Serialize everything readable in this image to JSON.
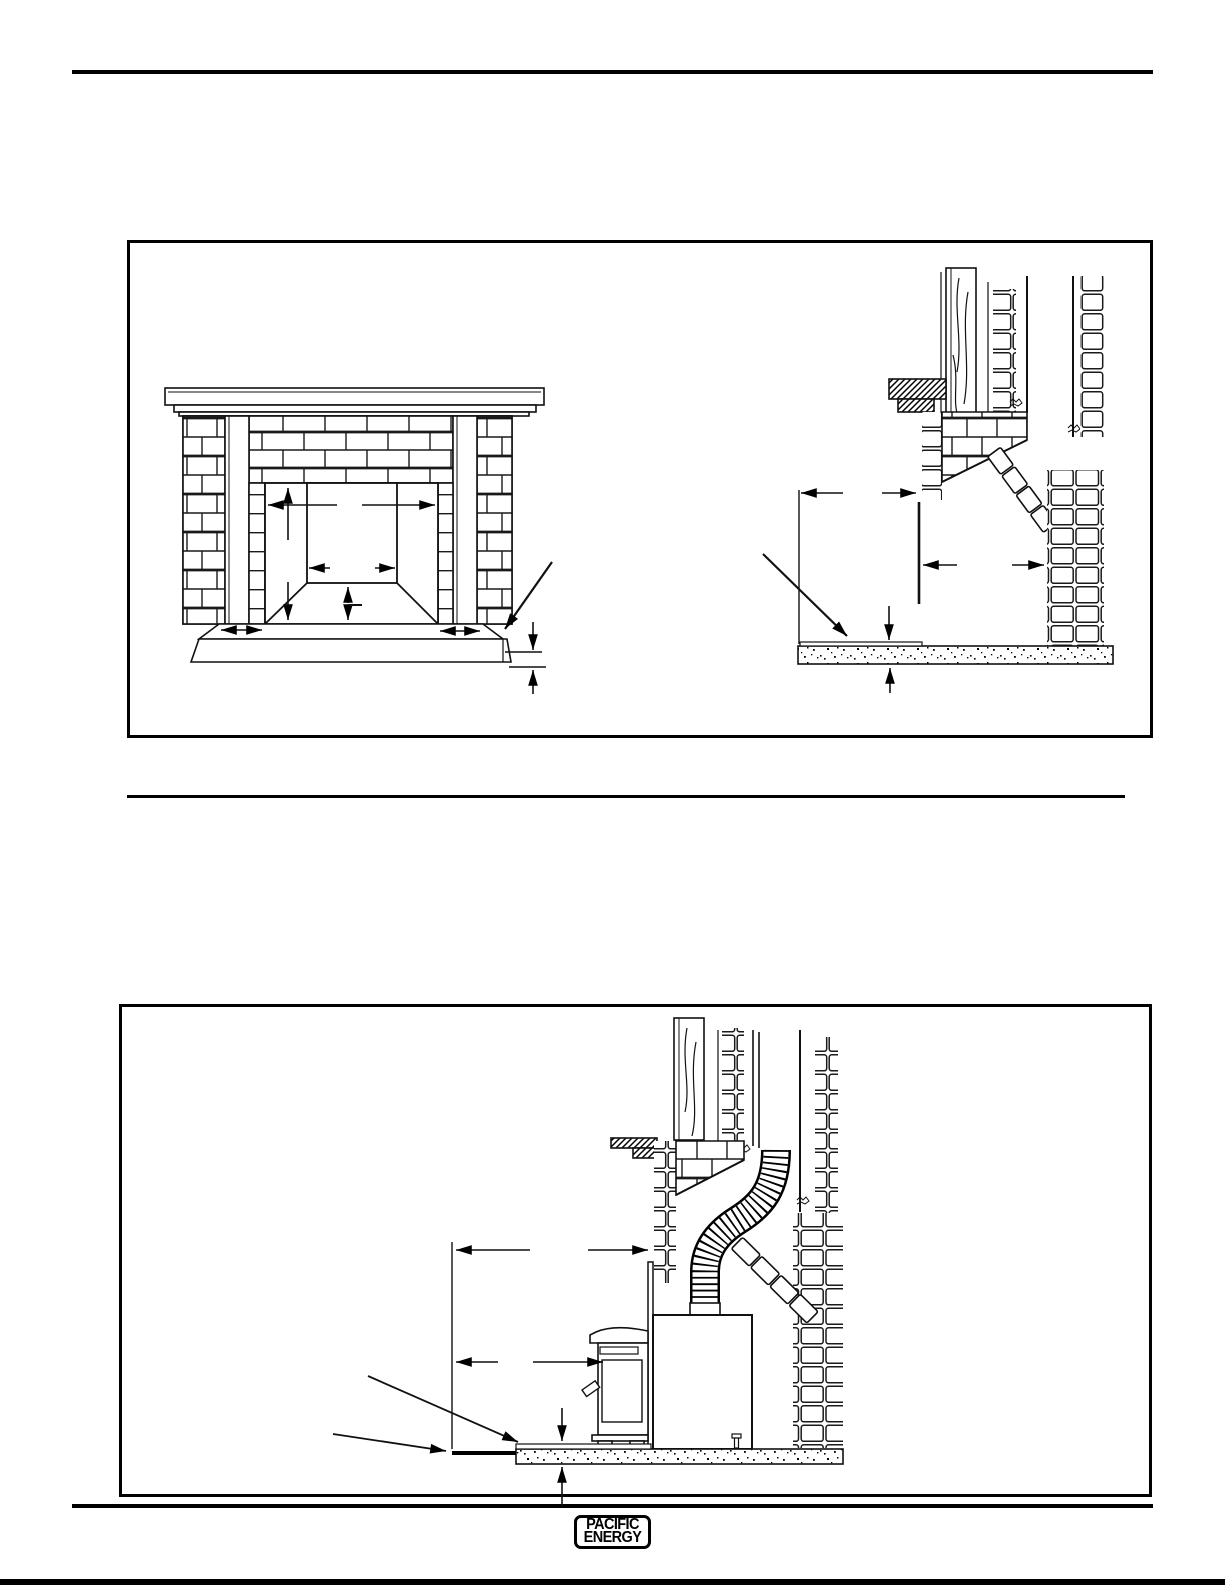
{
  "colors": {
    "paper": "#ffffff",
    "ink": "#000000"
  },
  "footer": {
    "logo_line1": "PACIFIC",
    "logo_line2": "ENERGY"
  }
}
